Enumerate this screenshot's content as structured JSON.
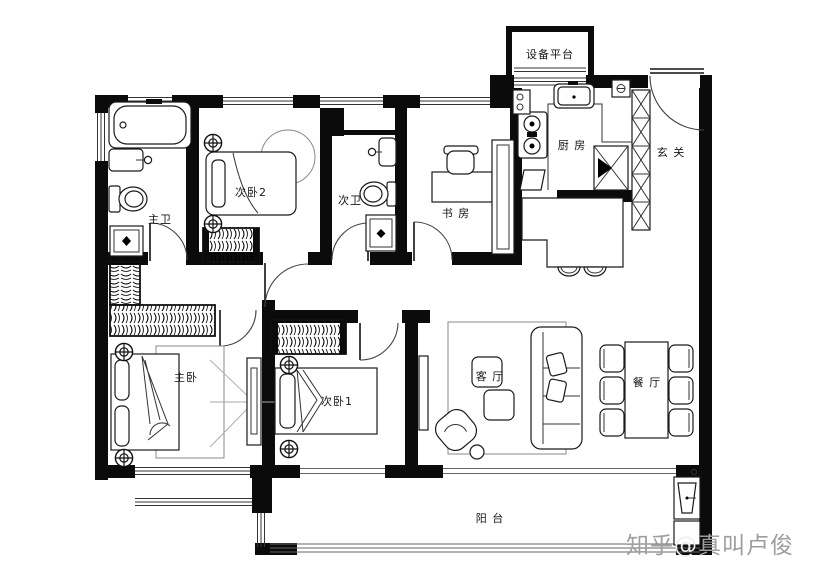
{
  "plan": {
    "rooms": {
      "equipment_platform": "设备平台",
      "kitchen": "厨 房",
      "entry": "玄 关",
      "bedroom2": "次卧2",
      "bath2": "次卫",
      "study": "书 房",
      "master_bath": "主卫",
      "master_bedroom": "主卧",
      "bedroom1": "次卧1",
      "living_room": "客 厅",
      "dining_room": "餐 厅",
      "balcony": "阳 台"
    }
  },
  "watermark": {
    "site": "知乎",
    "at": "@",
    "author": "真叫卢俊",
    "color": "#9e9e9e"
  },
  "colors": {
    "wall": "#0b0b0b",
    "furniture_line": "#1a1a1a",
    "sight_line": "#aaaaaa",
    "background": "#ffffff"
  }
}
